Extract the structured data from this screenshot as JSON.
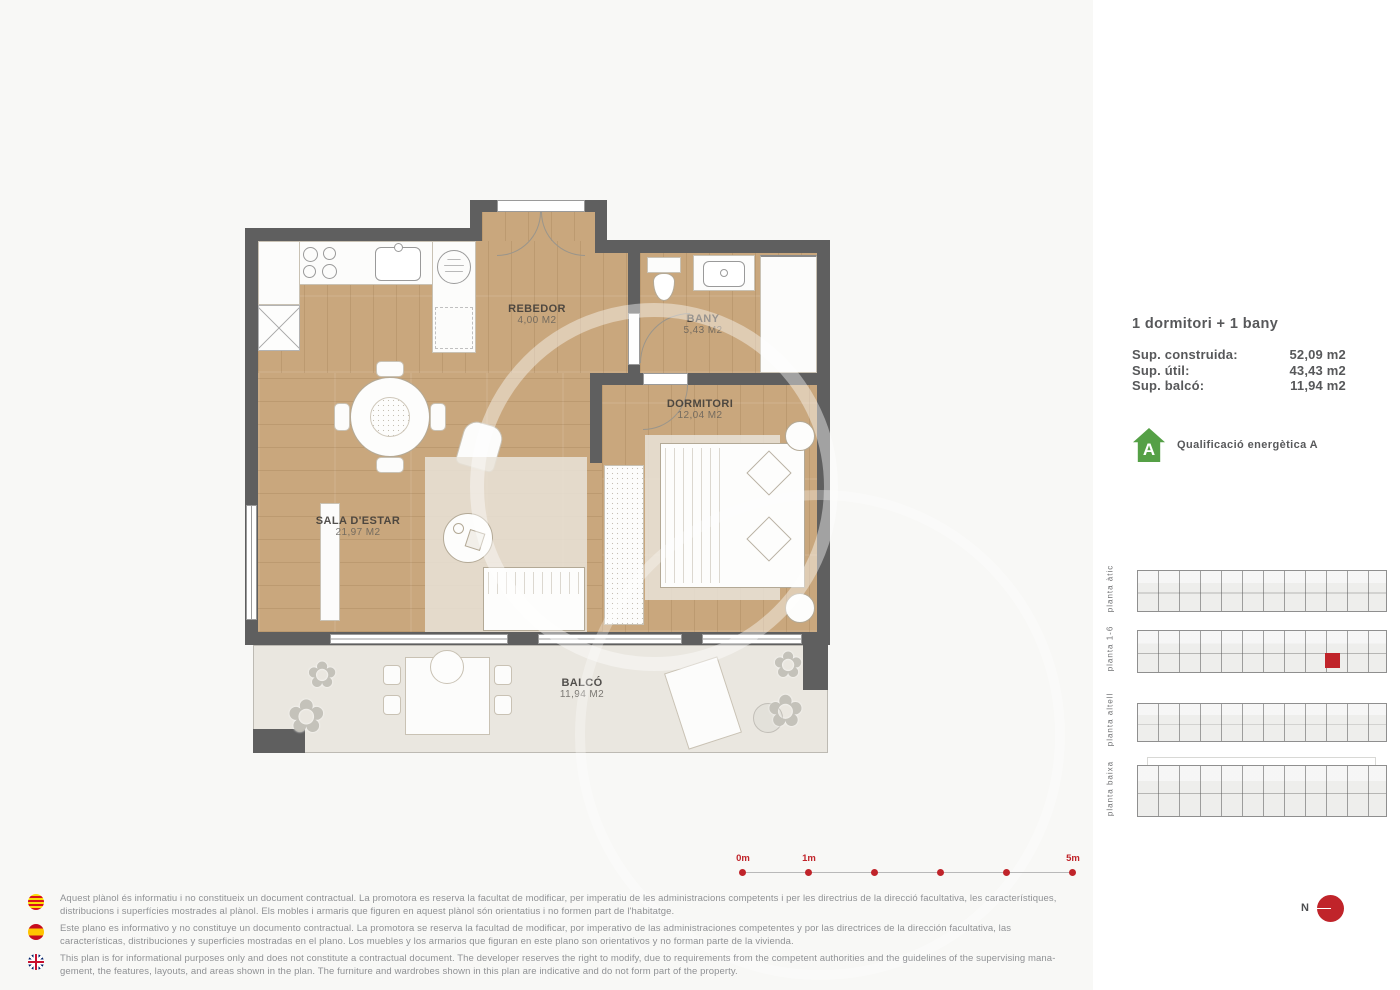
{
  "plan": {
    "rooms": [
      {
        "name": "REBEDOR",
        "area": "4,00 M2"
      },
      {
        "name": "BANY",
        "area": "5,43 M2"
      },
      {
        "name": "DORMITORI",
        "area": "12,04 M2"
      },
      {
        "name": "SALA D'ESTAR",
        "area": "21,97 M2"
      },
      {
        "name": "BALCÓ",
        "area": "11,94 M2"
      }
    ]
  },
  "details": {
    "title": "1 dormitori + 1 bany",
    "surfaces": [
      {
        "label": "Sup. construida:",
        "value": "52,09 m2"
      },
      {
        "label": "Sup. útil:",
        "value": "43,43 m2"
      },
      {
        "label": "Sup. balcó:",
        "value": "11,94 m2"
      }
    ],
    "energy_letter": "A",
    "energy_label": "Qualificació energètica A"
  },
  "floors": [
    {
      "label": "planta àtic"
    },
    {
      "label": "planta 1-6",
      "highlighted": true
    },
    {
      "label": "planta altell"
    },
    {
      "label": "planta baixa"
    }
  ],
  "scalebar": {
    "start": "0m",
    "first": "1m",
    "end": "5m"
  },
  "compass": {
    "label": "N"
  },
  "disclaimers": [
    {
      "flag": "catalonia-flag",
      "text": "Aquest plànol és informatiu i no constitueix un document contractual. La promotora es reserva la facultat de modificar, per imperatiu de les administracions competents i per les directrius de la direcció facultativa, les característiques, distribucions i superfícies mostrades al plànol. Els mobles i armaris que figuren en aquest plànol són orientatius i no formen part de l'habitatge."
    },
    {
      "flag": "spain-flag",
      "text": "Este plano es informativo y no constituye un documento contractual. La promotora se reserva la facultad de modificar, por imperativo de las administraciones competentes y por las directrices de la dirección facultativa, las características, distribuciones y superficies mostradas en el plano. Los muebles y los armarios que figuran en este plano son orientativos y no forman parte de la vivienda."
    },
    {
      "flag": "uk-flag",
      "text": "This plan is for informational purposes only and does not constitute a contractual document. The developer reserves the right to modify, due to requirements from the competent authorities and the guidelines of the supervising mana-gement, the features, layouts, and areas shown in the plan. The furniture and wardrobes shown in this plan are indicative and do not form part of the property."
    }
  ],
  "colors": {
    "accent_red": "#c0242a",
    "energy_green": "#55a046"
  }
}
